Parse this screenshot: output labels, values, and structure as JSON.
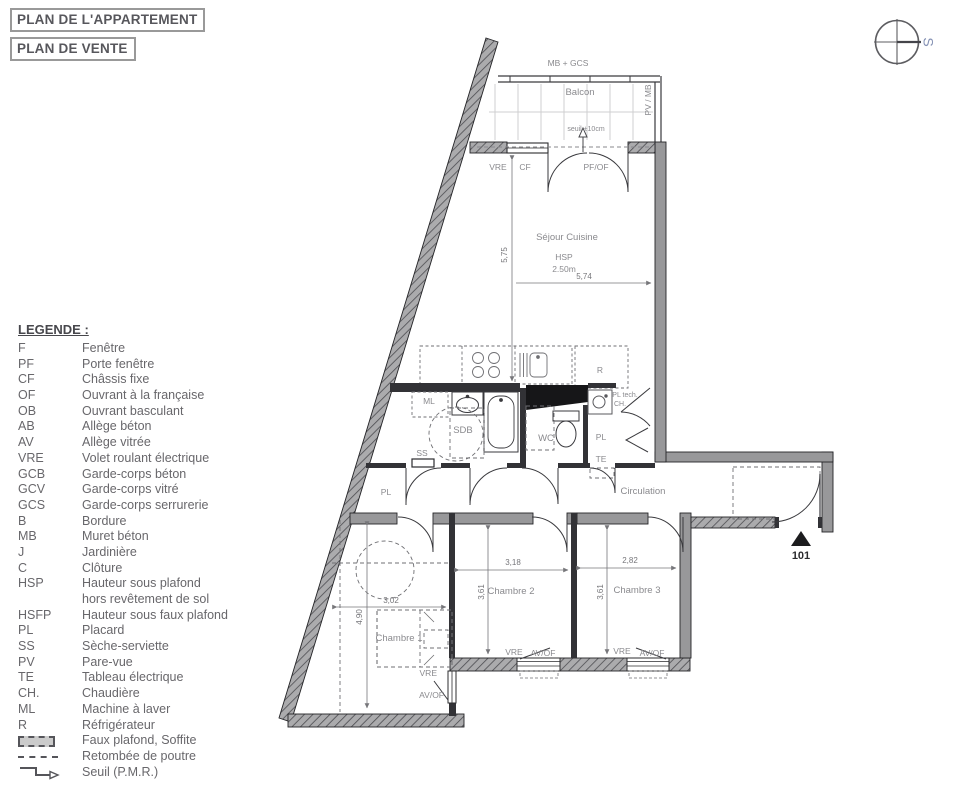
{
  "titles": {
    "line1": "PLAN DE L'APPARTEMENT",
    "line2": "PLAN DE VENTE"
  },
  "compass": {
    "south_label": "S",
    "accent_color": "#8491b4"
  },
  "colors": {
    "wall_gray": "#98989a",
    "partition_dark": "#323236",
    "legend_text": "#68676b",
    "label_gray": "#8a8a8e"
  },
  "legend": {
    "title": "LEGENDE :",
    "items": [
      {
        "abbr": "F",
        "label": "Fenêtre"
      },
      {
        "abbr": "PF",
        "label": "Porte fenêtre"
      },
      {
        "abbr": "CF",
        "label": "Châssis fixe"
      },
      {
        "abbr": "OF",
        "label": "Ouvrant à la française"
      },
      {
        "abbr": "OB",
        "label": "Ouvrant basculant"
      },
      {
        "abbr": "AB",
        "label": "Allège béton"
      },
      {
        "abbr": "AV",
        "label": "Allège vitrée"
      },
      {
        "abbr": "VRE",
        "label": "Volet roulant électrique"
      },
      {
        "abbr": "GCB",
        "label": "Garde-corps béton"
      },
      {
        "abbr": "GCV",
        "label": "Garde-corps vitré"
      },
      {
        "abbr": "GCS",
        "label": "Garde-corps serrurerie"
      },
      {
        "abbr": "B",
        "label": "Bordure"
      },
      {
        "abbr": "MB",
        "label": "Muret béton"
      },
      {
        "abbr": "J",
        "label": "Jardinière"
      },
      {
        "abbr": "C",
        "label": "Clôture"
      },
      {
        "abbr": "HSP",
        "label": "Hauteur sous plafond",
        "label2": "hors revêtement de sol"
      },
      {
        "abbr": "HSFP",
        "label": "Hauteur sous faux plafond"
      },
      {
        "abbr": "PL",
        "label": "Placard"
      },
      {
        "abbr": "SS",
        "label": "Sèche-serviette"
      },
      {
        "abbr": "PV",
        "label": "Pare-vue"
      },
      {
        "abbr": "TE",
        "label": "Tableau électrique"
      },
      {
        "abbr": "CH.",
        "label": "Chaudière"
      },
      {
        "abbr": "ML",
        "label": "Machine à laver"
      },
      {
        "abbr": "R",
        "label": "Réfrigérateur"
      }
    ],
    "symbol_items": [
      {
        "symbol": "faux-plafond-swatch",
        "label": "Faux plafond, Soffite"
      },
      {
        "symbol": "retombee-poutre-dashes",
        "label": "Retombée de poutre"
      },
      {
        "symbol": "seuil-pmr-step",
        "label": "Seuil (P.M.R.)"
      }
    ]
  },
  "plan": {
    "rooms": {
      "balcon": "Balcon",
      "sejour": "Séjour Cuisine",
      "sdb": "SDB",
      "wc": "WC",
      "circulation": "Circulation",
      "chambre1": "Chambre 1",
      "chambre2": "Chambre 2",
      "chambre3": "Chambre 3"
    },
    "labels": {
      "mb_gcs": "MB + GCS",
      "pv_mb": "PV / MB",
      "seuil": "seuil ±10cm",
      "vre": "VRE",
      "cf": "CF",
      "pf_of": "PF/OF",
      "av_of": "AV/OF",
      "hsp": "HSP",
      "hsp_value": "2.50m",
      "ml": "ML",
      "r": "R",
      "ss": "SS",
      "pl": "PL",
      "pl_tech": "PL tech.",
      "ch": "CH.",
      "te": "TE",
      "door_number": "101"
    },
    "dimensions": {
      "sejour_w": "5,74",
      "sejour_h": "5,75",
      "ch1_w": "3,02",
      "ch1_h": "4,90",
      "ch2_w": "3,18",
      "ch2_h": "3,61",
      "ch3_w": "2,82",
      "ch3_h": "3,61"
    }
  }
}
